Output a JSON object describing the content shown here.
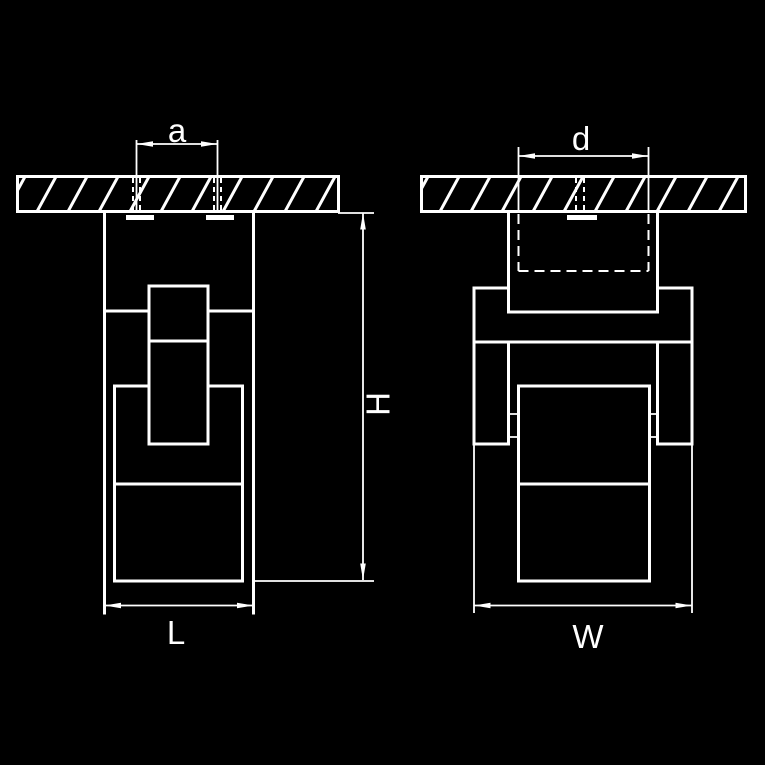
{
  "drawing": {
    "colors": {
      "background": "#000000",
      "lines": "#ffffff"
    },
    "views": {
      "front": {
        "labels": {
          "mount_spacing": "a",
          "length": "L",
          "height": "H"
        }
      },
      "side": {
        "labels": {
          "cutout_width": "d",
          "width": "W"
        }
      }
    }
  }
}
